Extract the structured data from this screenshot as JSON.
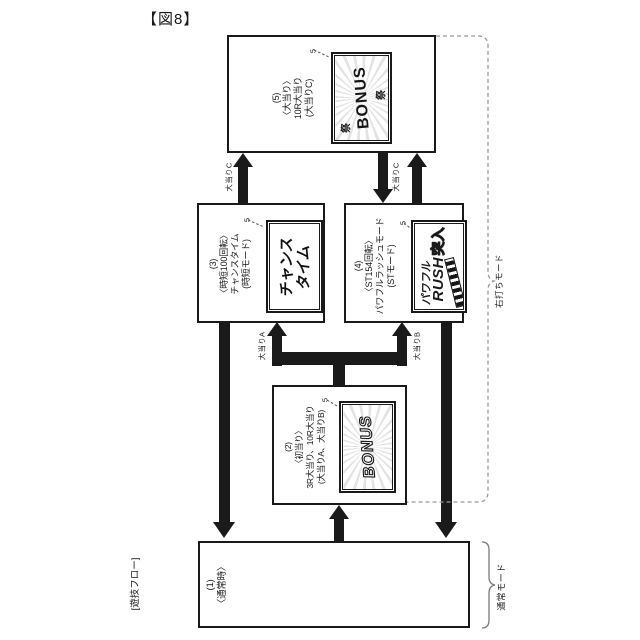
{
  "figure_label": "【図8】",
  "flow_label": "[遊技フロー]",
  "nodes": {
    "n1": {
      "num": "(1)",
      "cond": "〈通常時〉"
    },
    "n2": {
      "num": "(2)",
      "cond": "〈初当り〉",
      "name": "3R大当り、10R大当り",
      "mode": "(大当りA、大当りB)",
      "screen_ref": "5",
      "screen_text": "BONUS"
    },
    "n3": {
      "num": "(3)",
      "cond": "〈時短100回転〉",
      "name": "チャンスタイム",
      "mode": "(時短モード)",
      "screen_ref": "5",
      "screen_line1": "チャンス",
      "screen_line2": "タイム"
    },
    "n4": {
      "num": "(4)",
      "cond": "〈ST154回転〉",
      "name": "パワフルラッシュモード",
      "mode": "(STモード)",
      "screen_ref": "5",
      "screen_line1": "パワフル",
      "screen_line2": "RUSH",
      "screen_line3": "突入"
    },
    "n5": {
      "num": "(5)",
      "cond": "〈大当り〉",
      "name": "10R大当り",
      "mode": "(大当りC)",
      "screen_ref": "5",
      "screen_text": "BONUS",
      "screen_stamp": "祭"
    }
  },
  "arrow_labels": {
    "c_left": "大当りC",
    "c_right": "大当りC",
    "a": "大当りA",
    "b": "大当りB"
  },
  "mode_labels": {
    "right": "右打ちモード",
    "normal": "通常モード"
  },
  "colors": {
    "line": "#1a1a1a",
    "arrow": "#1a1a1a",
    "dashed_bracket": "#9a9a9a",
    "solid_brace": "#7a7a7a",
    "background": "#ffffff"
  }
}
